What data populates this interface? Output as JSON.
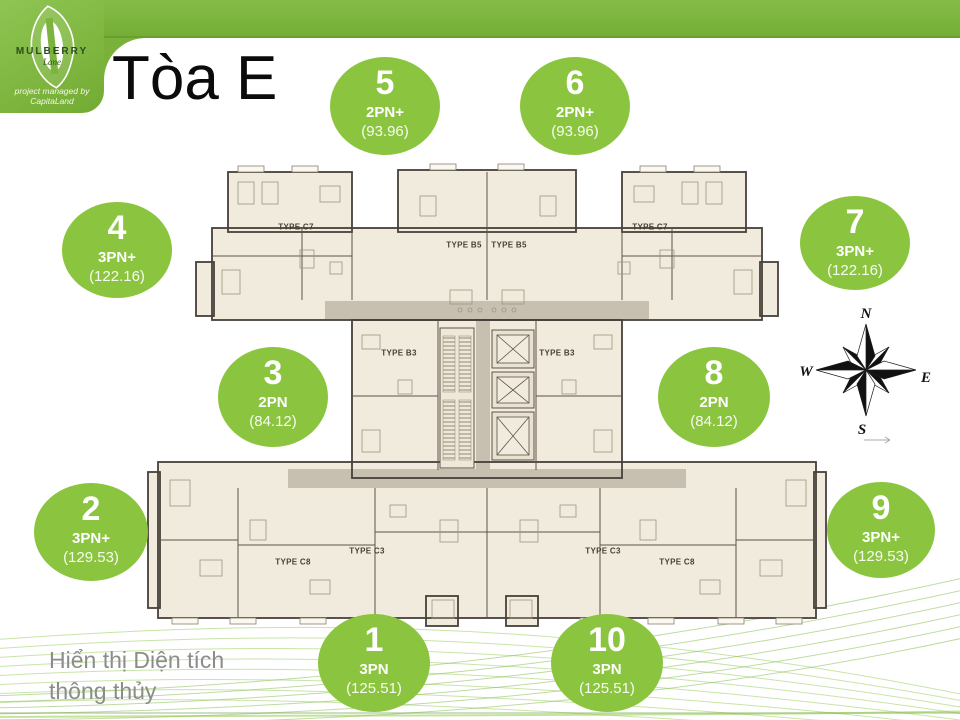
{
  "header": {
    "logo": {
      "brand": "MULBERRY",
      "brand_sub": "Lane",
      "managed_by": "project managed by CapitaLand"
    },
    "title": "Tòa E"
  },
  "units": [
    {
      "no": "1",
      "type": "3PN",
      "area": "(125.51)"
    },
    {
      "no": "2",
      "type": "3PN+",
      "area": "(129.53)"
    },
    {
      "no": "3",
      "type": "2PN",
      "area": "(84.12)"
    },
    {
      "no": "4",
      "type": "3PN+",
      "area": "(122.16)"
    },
    {
      "no": "5",
      "type": "2PN+",
      "area": "(93.96)"
    },
    {
      "no": "6",
      "type": "2PN+",
      "area": "(93.96)"
    },
    {
      "no": "7",
      "type": "3PN+",
      "area": "(122.16)"
    },
    {
      "no": "8",
      "type": "2PN",
      "area": "(84.12)"
    },
    {
      "no": "9",
      "type": "3PN+",
      "area": "(129.53)"
    },
    {
      "no": "10",
      "type": "3PN",
      "area": "(125.51)"
    }
  ],
  "plan": {
    "labels": [
      "TYPE C7",
      "TYPE B5",
      "TYPE B5",
      "TYPE C7",
      "TYPE B3",
      "TYPE B3",
      "TYPE C8",
      "TYPE C3",
      "TYPE C3",
      "TYPE C8"
    ]
  },
  "compass": {
    "north": "N",
    "east": "E",
    "south": "S",
    "west": "W"
  },
  "footer": {
    "note_lines": [
      "Hiển thị Diện tích",
      "thông thủy"
    ]
  },
  "colors": {
    "circle_green": "#8bc53f",
    "bar_green": "#7db440",
    "corridor": "#c7c0b1"
  }
}
